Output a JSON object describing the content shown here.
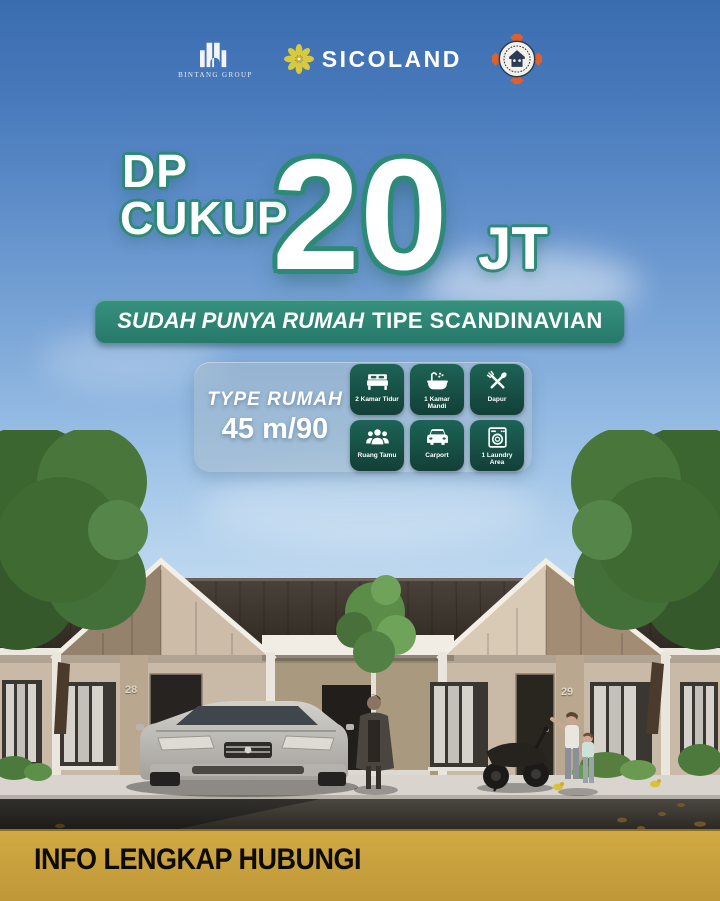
{
  "poster": {
    "header": {
      "bintang_group": {
        "name": "BINTANG GROUP"
      },
      "sicoland": {
        "name": "SICOLAND"
      }
    },
    "headline": {
      "line1": "DP",
      "line2": "CUKUP",
      "amount": "20",
      "unit": "JT"
    },
    "banner": {
      "italic": "SUDAH PUNYA RUMAH",
      "bold": "TIPE SCANDINAVIAN"
    },
    "spec_card": {
      "title": "TYPE RUMAH",
      "size": "45 m/90",
      "features": [
        {
          "icon": "bed-icon",
          "label": "2 Kamar Tidur"
        },
        {
          "icon": "bathtub-icon",
          "label": "1 Kamar Mandi"
        },
        {
          "icon": "cutlery-icon",
          "label": "Dapur"
        },
        {
          "icon": "family-icon",
          "label": "Ruang Tamu"
        },
        {
          "icon": "car-icon",
          "label": "Carport"
        },
        {
          "icon": "washer-icon",
          "label": "1 Laundry Area"
        }
      ]
    },
    "scene": {
      "house_number_left": "28",
      "house_number_right": "29"
    },
    "footer": {
      "text": "INFO LENGKAP HUBUNGI"
    },
    "colors": {
      "accent_teal": "#2E8A78",
      "banner_green": "#27796A",
      "tile_green": "#123F37",
      "gold": "#C09737",
      "sky_top": "#3A6CB0",
      "roof_brown": "#3A332B",
      "wall_beige": "#C9BAA7"
    }
  }
}
